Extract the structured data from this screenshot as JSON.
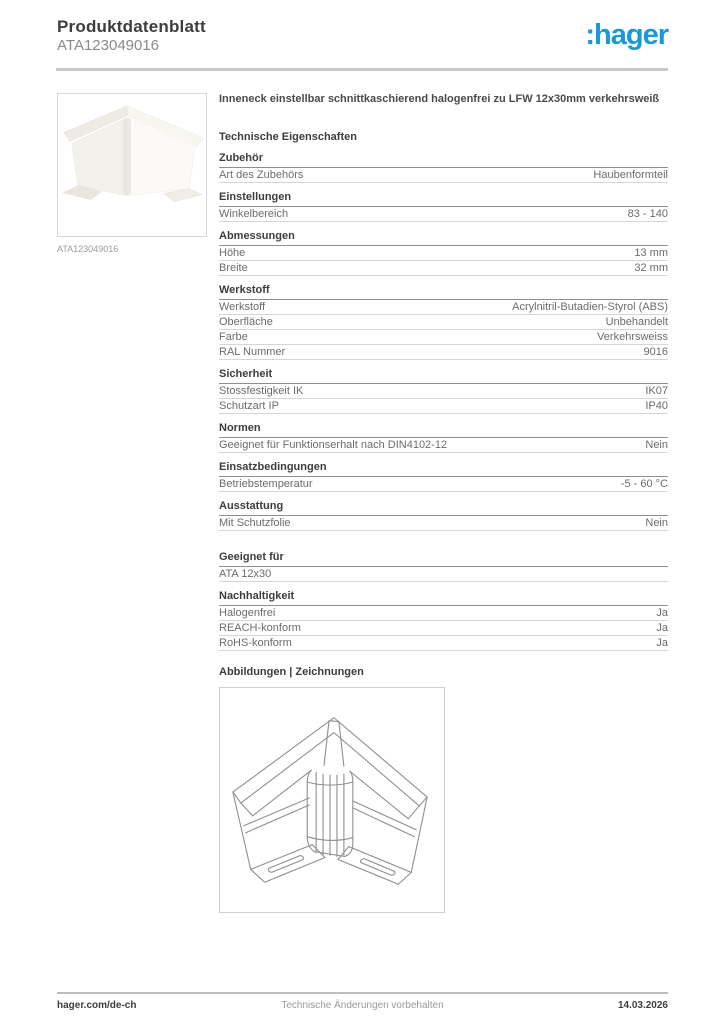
{
  "header": {
    "title": "Produktdatenblatt",
    "subtitle": "ATA123049016",
    "logo_text": ":hager",
    "logo_color": "#189ad6"
  },
  "product": {
    "description": "Inneneck einstellbar schnittkaschierend halogenfrei zu LFW 12x30mm verkehrsweiß",
    "image_caption": "ATA123049016",
    "image_alt": "inner-corner-piece-photo"
  },
  "specs": {
    "title": "Technische Eigenschaften",
    "sections": [
      {
        "title": "Zubehör",
        "rows": [
          {
            "label": "Art des Zubehörs",
            "value": "Haubenformteil"
          }
        ]
      },
      {
        "title": "Einstellungen",
        "rows": [
          {
            "label": "Winkelbereich",
            "value": "83 - 140"
          }
        ]
      },
      {
        "title": "Abmessungen",
        "rows": [
          {
            "label": "Höhe",
            "value": "13 mm"
          },
          {
            "label": "Breite",
            "value": "32 mm"
          }
        ]
      },
      {
        "title": "Werkstoff",
        "rows": [
          {
            "label": "Werkstoff",
            "value": "Acrylnitril-Butadien-Styrol (ABS)"
          },
          {
            "label": "Oberfläche",
            "value": "Unbehandelt"
          },
          {
            "label": "Farbe",
            "value": "Verkehrsweiss"
          },
          {
            "label": "RAL Nummer",
            "value": "9016"
          }
        ]
      },
      {
        "title": "Sicherheit",
        "rows": [
          {
            "label": "Stossfestigkeit IK",
            "value": "IK07"
          },
          {
            "label": "Schutzart IP",
            "value": "IP40"
          }
        ]
      },
      {
        "title": "Normen",
        "rows": [
          {
            "label": "Geeignet für Funktionserhalt nach DIN4102-12",
            "value": "Nein"
          }
        ]
      },
      {
        "title": "Einsatzbedingungen",
        "rows": [
          {
            "label": "Betriebstemperatur",
            "value": "-5 - 60 °C"
          }
        ]
      },
      {
        "title": "Ausstattung",
        "rows": [
          {
            "label": "Mit Schutzfolie",
            "value": "Nein"
          }
        ]
      },
      {
        "title": "Geeignet für",
        "extra_gap": true,
        "rows": [
          {
            "label": "ATA 12x30",
            "value": ""
          }
        ]
      },
      {
        "title": "Nachhaltigkeit",
        "rows": [
          {
            "label": "Halogenfrei",
            "value": "Ja"
          },
          {
            "label": "REACH-konform",
            "value": "Ja"
          },
          {
            "label": "RoHS-konform",
            "value": "Ja"
          }
        ]
      }
    ]
  },
  "drawings": {
    "title": "Abbildungen | Zeichnungen",
    "image_alt": "inner-corner-wireframe-drawing"
  },
  "footer": {
    "left": "hager.com/de-ch",
    "center": "Technische Änderungen vorbehalten",
    "right": "14.03.2026"
  }
}
